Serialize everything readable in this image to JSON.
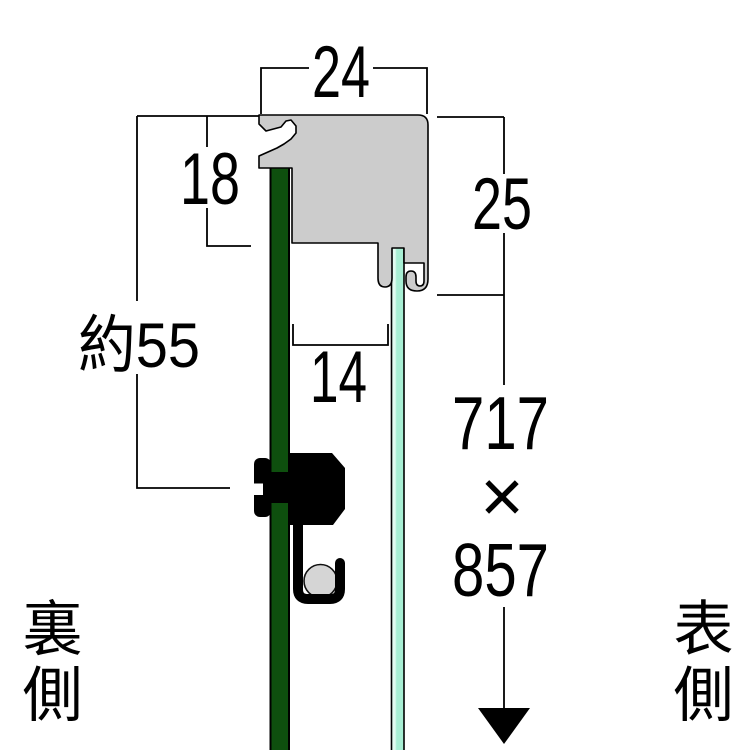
{
  "diagram": {
    "description": "Frame profile cross-section diagram",
    "labels": {
      "width_top": "24",
      "back_depth": "18",
      "face_height": "25",
      "total_depth": "約55",
      "inner_gap": "14",
      "opening_width": "717",
      "size_separator": "×",
      "opening_height": "857",
      "back_side": "裏側",
      "front_side": "表側"
    },
    "colors": {
      "frame_profile": "#cccccc",
      "back_board": "#0e4f0e",
      "glass_panel": "#a8efd4",
      "glass_highlight": "#e2fbf1",
      "roller": "#d5d5d5",
      "hardware": "#000000",
      "line": "#000000",
      "background": "#ffffff"
    }
  }
}
